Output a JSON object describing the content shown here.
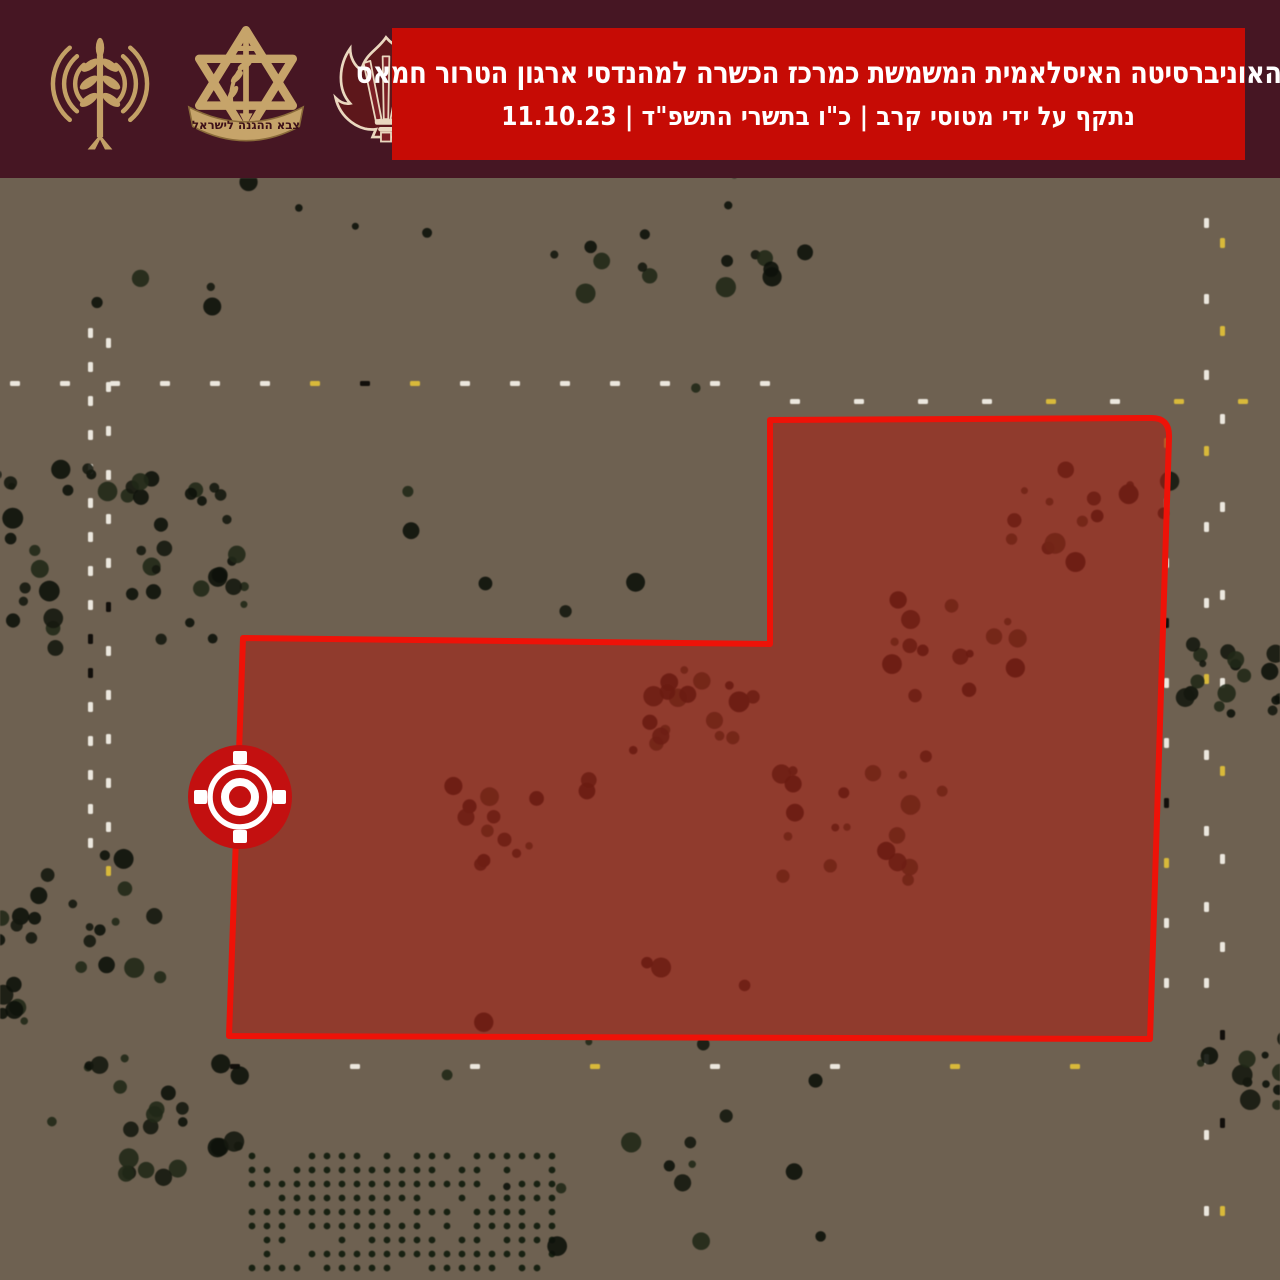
{
  "page": {
    "type": "military-strike-infographic",
    "language": "he"
  },
  "header": {
    "background_color": "#461623",
    "banner": {
      "background_color": "#c60b05",
      "text_color": "#ffffff",
      "title": "האוניברסיטה האיסלאמית המשמשת כמרכז הכשרה למהנדסי ארגון הטרור חמאס",
      "subtitle": "נתקף על ידי מטוסי קרב | כ\"ו בתשרי התשפ\"ד | 11.10.23",
      "strike_method": "נתקף על ידי מטוסי קרב",
      "hebrew_date": "כ\"ו בתשרי התשפ\"ד",
      "date": "11.10.23"
    },
    "logos": [
      {
        "name": "idf-spokesperson-antenna-emblem",
        "description": "gold antenna with radio waves and olive branch"
      },
      {
        "name": "idf-emblem",
        "description": "gold Star of David with sword and olive branch",
        "ribbon_text": "צבא ההגנה לישראל"
      },
      {
        "name": "flame-swords-emblem",
        "description": "dark red flaming swords emblem with cream outline"
      }
    ]
  },
  "map": {
    "kind": "satellite-aerial-photo",
    "overlay": {
      "fill_color": "rgba(210,42,28,0.46)",
      "undertint_color": "rgba(40,16,8,0.28)",
      "border_color": "#ee1208",
      "border_width": 6,
      "polygon_path": "M 243 460 L 770 466 L 770 242 L 1150 240 Q 1170 239 1169 260 L 1150 861 L 229 858 Z",
      "target": {
        "x": 240,
        "y": 619,
        "color": "#c31010",
        "radius": 52
      }
    }
  }
}
